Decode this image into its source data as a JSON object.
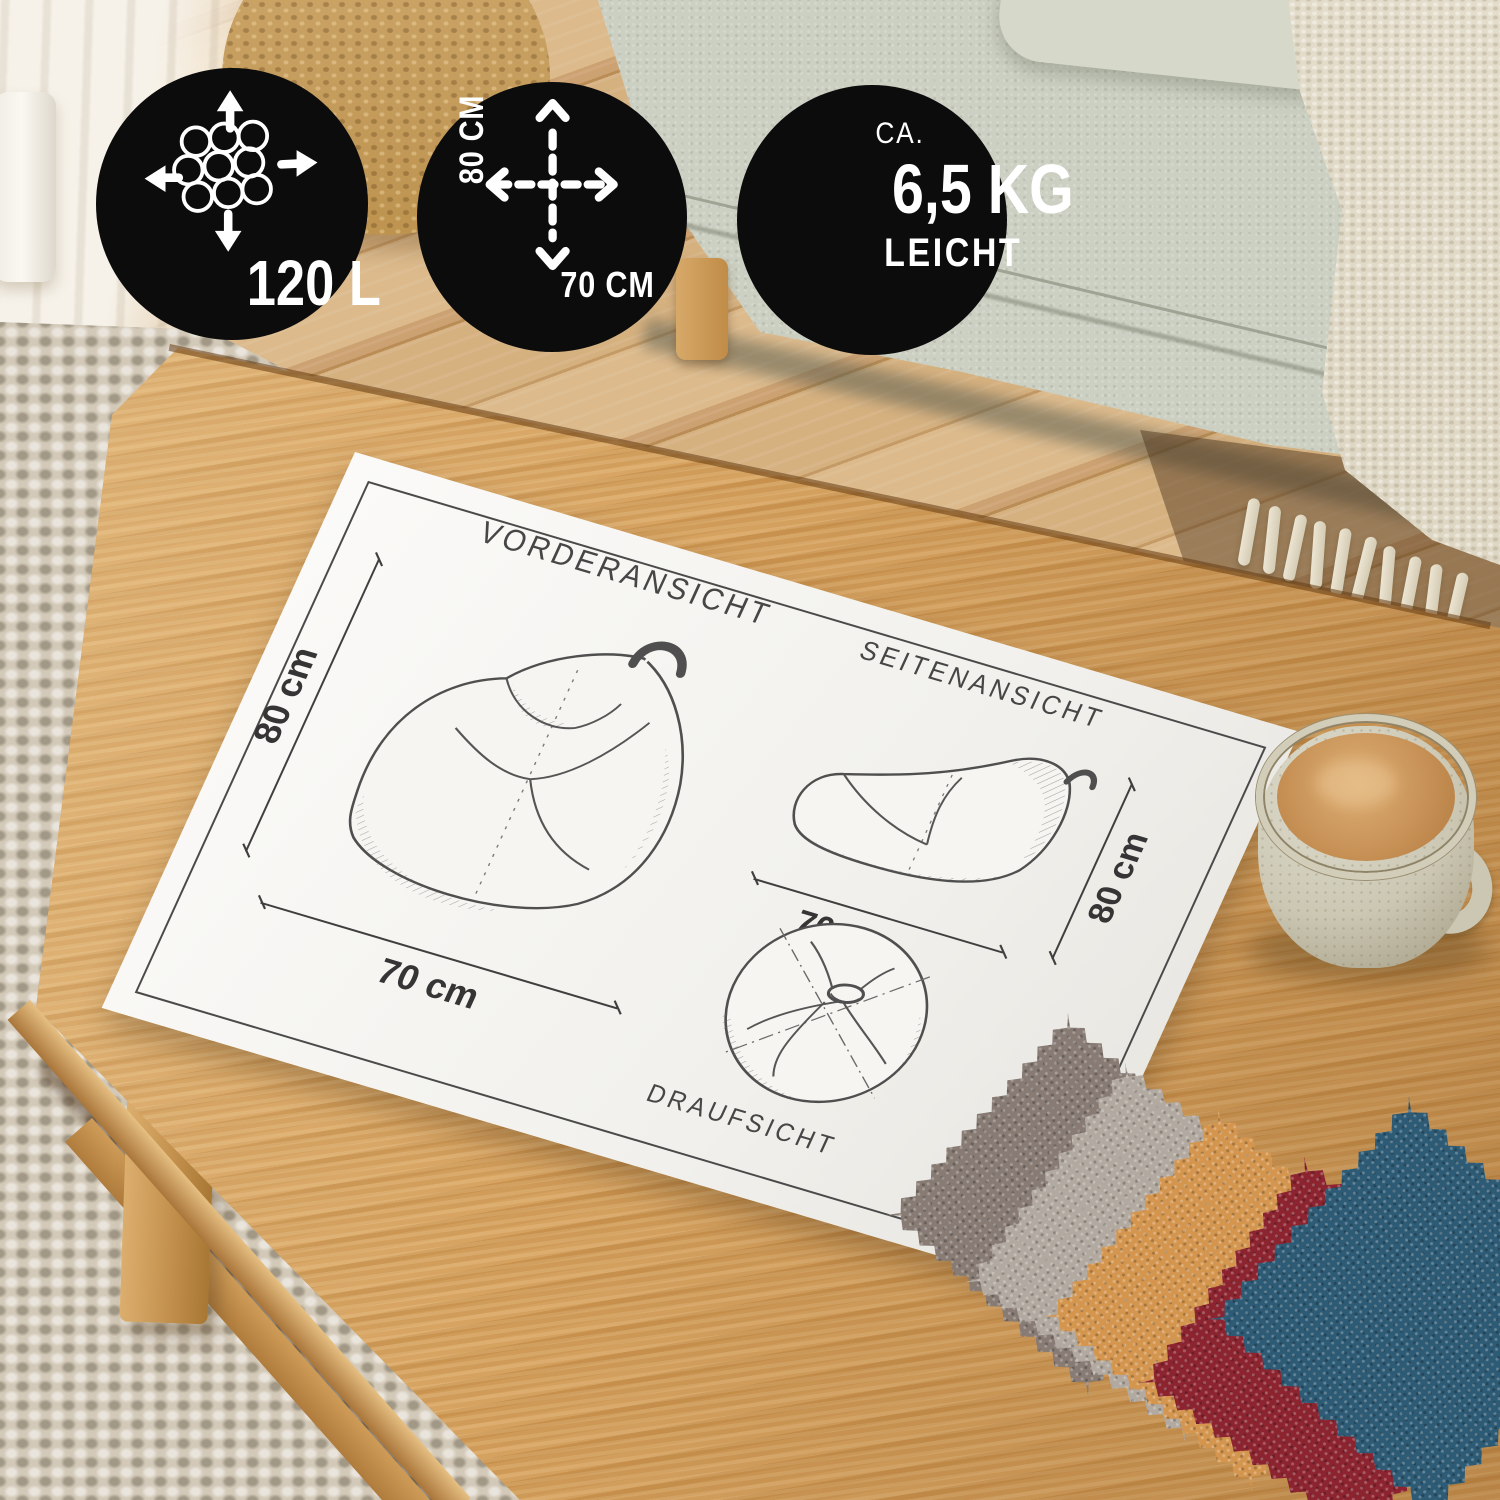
{
  "badges": {
    "capacity": {
      "value": "120 L",
      "icon": "filling-beads-expand-icon"
    },
    "dimensions": {
      "height": "80 CM",
      "width": "70 CM",
      "icon": "cross-arrows-icon"
    },
    "weight": {
      "prefix": "CA.",
      "value": "6,5 KG",
      "suffix": "LEICHT"
    }
  },
  "paper": {
    "front_view": {
      "title": "VORDERANSICHT",
      "height_label": "80 cm",
      "width_label": "70 cm"
    },
    "side_view": {
      "title": "SEITENANSICHT",
      "width_label": "70 cm",
      "height_label": "80 cm"
    },
    "top_view": {
      "title": "DRAUFSICHT"
    }
  },
  "swatches": [
    {
      "name": "warm-gray",
      "hex": "#877b74"
    },
    {
      "name": "light-gray",
      "hex": "#b2a9a0"
    },
    {
      "name": "amber-orange",
      "hex": "#d4964f"
    },
    {
      "name": "burgundy-red",
      "hex": "#8c2430"
    },
    {
      "name": "petrol-blue",
      "hex": "#2d5a74"
    }
  ],
  "colors": {
    "badge_background": "#0c0c0c",
    "badge_text": "#ffffff",
    "paper": "#f6f5f2",
    "sketch_ink": "#4a4a4a",
    "table_wood": "#cd9752",
    "floor_wood": "#d9b586",
    "sofa_fabric": "#c7cbbd",
    "rug": "#cdc3b1",
    "blanket": "#ded7c4",
    "coffee": "#c89257",
    "mug_ceramic": "#cfcab6"
  }
}
